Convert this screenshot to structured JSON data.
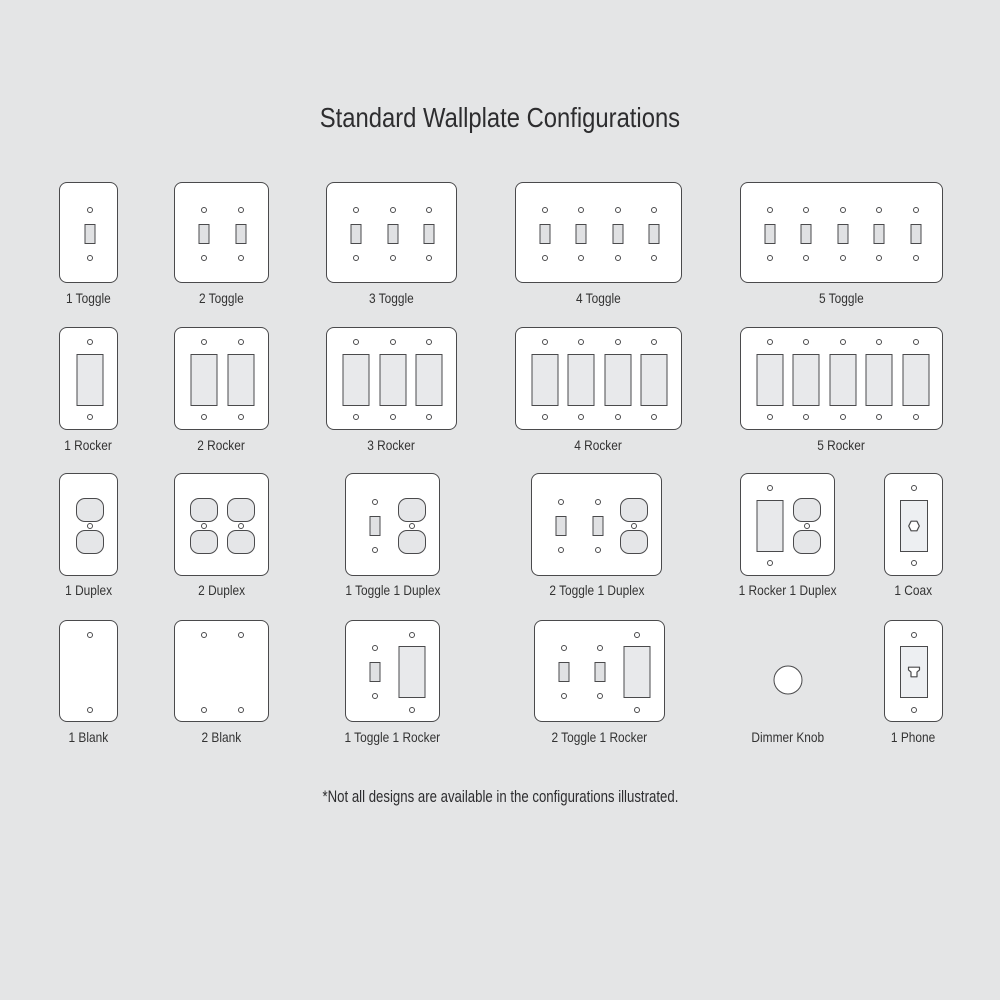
{
  "title": "Standard Wallplate Configurations",
  "footnote": "*Not all designs are available in the configurations illustrated.",
  "colors": {
    "background": "#e4e5e6",
    "plate_fill": "#ffffff",
    "outline": "#4a4a4c",
    "toggle_fill": "#e0e1e3",
    "rocker_fill": "#e8e9eb",
    "duplex_fill": "#e5e6e8",
    "jack_fill": "#edeff2",
    "title_text": "#2d2d2f",
    "label_text": "#333333"
  },
  "rows": [
    {
      "plates": [
        {
          "label": "1 Toggle",
          "units": [
            "toggle"
          ]
        },
        {
          "label": "2 Toggle",
          "units": [
            "toggle",
            "toggle"
          ]
        },
        {
          "label": "3 Toggle",
          "units": [
            "toggle",
            "toggle",
            "toggle"
          ]
        },
        {
          "label": "4 Toggle",
          "units": [
            "toggle",
            "toggle",
            "toggle",
            "toggle"
          ]
        },
        {
          "label": "5 Toggle",
          "units": [
            "toggle",
            "toggle",
            "toggle",
            "toggle",
            "toggle"
          ]
        }
      ]
    },
    {
      "plates": [
        {
          "label": "1 Rocker",
          "units": [
            "rocker"
          ]
        },
        {
          "label": "2 Rocker",
          "units": [
            "rocker",
            "rocker"
          ]
        },
        {
          "label": "3 Rocker",
          "units": [
            "rocker",
            "rocker",
            "rocker"
          ]
        },
        {
          "label": "4 Rocker",
          "units": [
            "rocker",
            "rocker",
            "rocker",
            "rocker"
          ]
        },
        {
          "label": "5 Rocker",
          "units": [
            "rocker",
            "rocker",
            "rocker",
            "rocker",
            "rocker"
          ]
        }
      ]
    },
    {
      "plates": [
        {
          "label": "1 Duplex",
          "units": [
            "duplex"
          ]
        },
        {
          "label": "2 Duplex",
          "units": [
            "duplex",
            "duplex"
          ]
        },
        {
          "label": "1 Toggle 1 Duplex",
          "units": [
            "toggle",
            "duplex"
          ]
        },
        {
          "label": "2 Toggle 1 Duplex",
          "units": [
            "toggle",
            "toggle",
            "duplex"
          ]
        },
        {
          "label": "1 Rocker 1 Duplex",
          "units": [
            "rocker",
            "duplex"
          ]
        },
        {
          "label": "1 Coax",
          "units": [
            "coax"
          ]
        }
      ]
    },
    {
      "plates": [
        {
          "label": "1 Blank",
          "units": [
            "blank"
          ]
        },
        {
          "label": "2 Blank",
          "units": [
            "blank",
            "blank"
          ]
        },
        {
          "label": "1 Toggle 1 Rocker",
          "units": [
            "toggle",
            "rocker"
          ]
        },
        {
          "label": "2 Toggle 1 Rocker",
          "units": [
            "toggle",
            "toggle",
            "rocker"
          ]
        },
        {
          "label": "Dimmer Knob",
          "units": [
            "dimmer"
          ]
        },
        {
          "label": "1 Phone",
          "units": [
            "phone"
          ]
        }
      ]
    }
  ]
}
